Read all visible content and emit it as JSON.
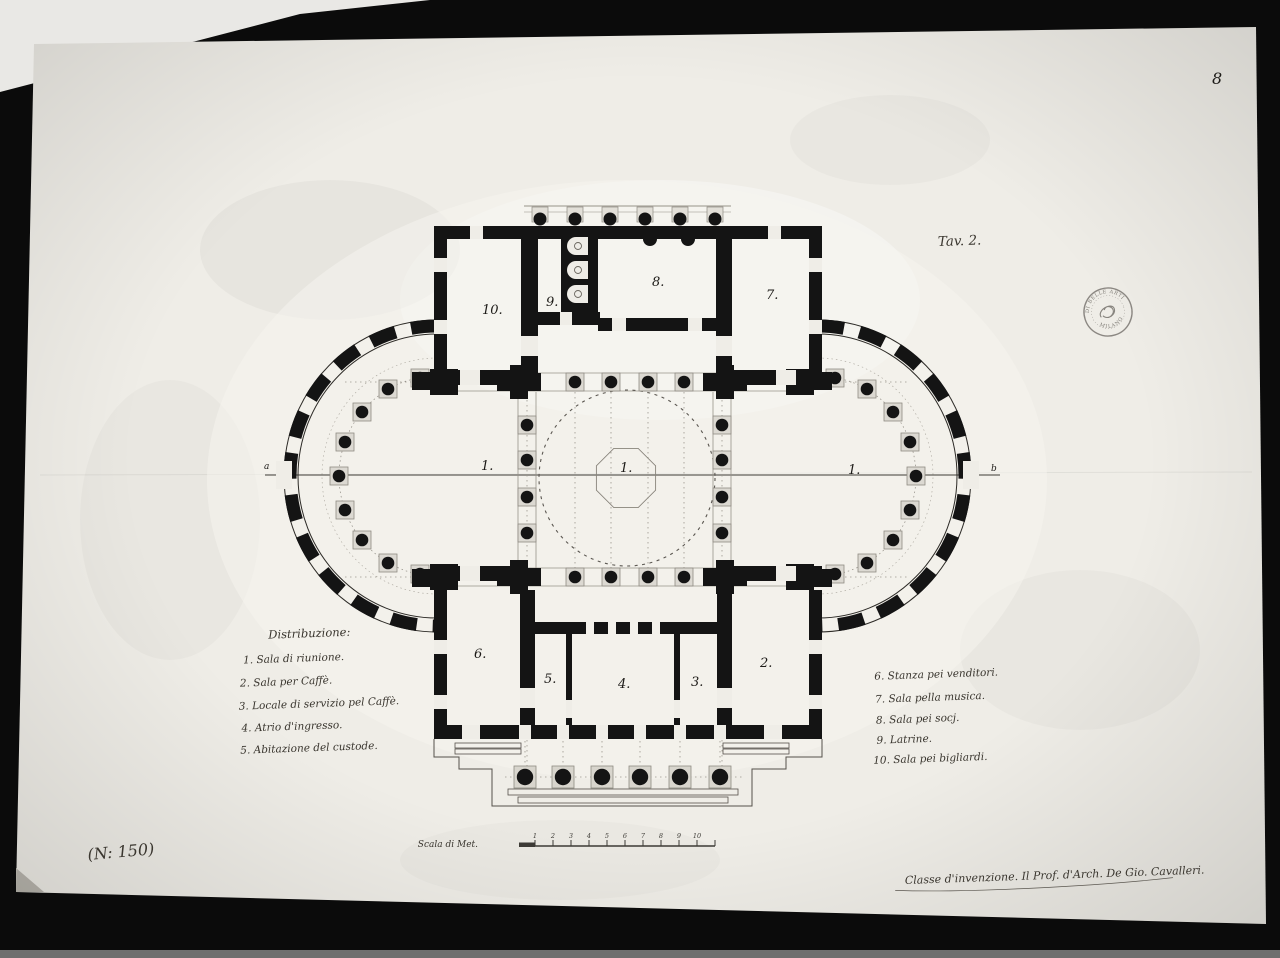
{
  "photo": {
    "page_number": "8",
    "inventory_number": "(N: 150)"
  },
  "plate": {
    "label": "Tav. 2."
  },
  "stamp": {
    "line_top": "DI BELLE ARTI",
    "line_bottom": "MILANO"
  },
  "legend_left": {
    "title": "Distribuzione:",
    "items": [
      "1. Sala di riunione.",
      "2. Sala per Caffè.",
      "3. Locale di servizio pel Caffè.",
      "4. Atrio d'ingresso.",
      "5. Abitazione del custode."
    ]
  },
  "legend_right": {
    "items": [
      "6. Stanza pei venditori.",
      "7. Sala pella musica.",
      "8. Sala pei socj.",
      "9. Latrine.",
      "10. Sala pei bigliardi."
    ]
  },
  "scale": {
    "label": "Scala di Met.",
    "ticks": [
      "1",
      "2",
      "3",
      "4",
      "5",
      "6",
      "7",
      "8",
      "9",
      "10"
    ]
  },
  "signature": "Classe d'invenzione. Il Prof. d'Arch. De Gio. Cavalleri.",
  "plan": {
    "labels": {
      "r10": "10.",
      "r9": "9.",
      "r8": "8.",
      "r7": "7.",
      "hall_left": "1.",
      "hall_center": "1.",
      "hall_right": "1.",
      "r6": "6.",
      "r5": "5.",
      "r4": "4.",
      "r3": "3.",
      "r2": "2.",
      "axis_a": "a",
      "axis_b": "b"
    }
  }
}
